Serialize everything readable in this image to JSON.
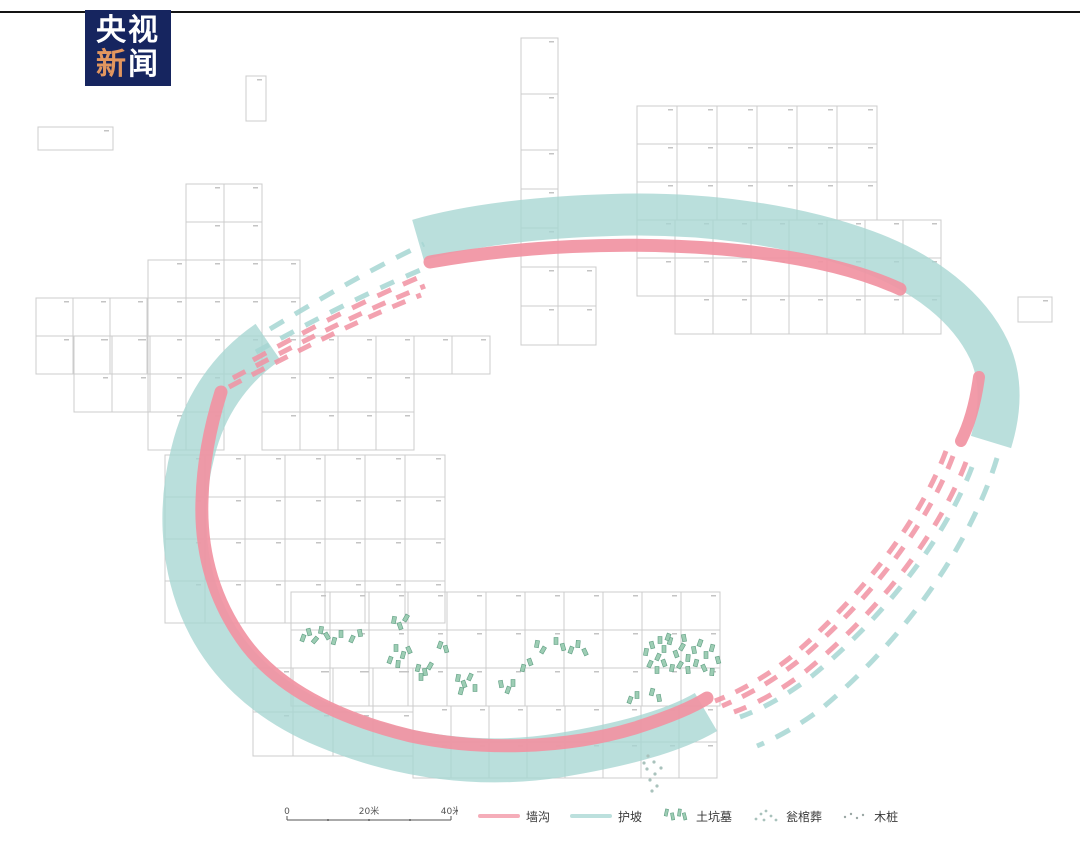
{
  "header": {
    "logo": {
      "char1": "央",
      "char2": "视",
      "char3": "新",
      "char4": "闻",
      "bg": "#16255f",
      "accent": "#e2965f",
      "text_color": "#ffffff"
    }
  },
  "colors": {
    "slope_teal": "#a6d6d2",
    "ditch_pink": "#f192a2",
    "grid_line": "#cccccc",
    "cell_mark": "#c4c4c4",
    "tomb_fill": "#9dcdb4",
    "tomb_stroke": "#5f9e82",
    "dot": "#a9c2bc",
    "scale_line": "#555555",
    "label_text": "#3a3a3a",
    "top_line": "#141414"
  },
  "legend": {
    "scale": {
      "labels": [
        "0",
        "20米",
        "40米"
      ]
    },
    "items": [
      {
        "type": "line",
        "color": "ditch_pink",
        "label": "墙沟"
      },
      {
        "type": "line",
        "color": "slope_teal",
        "label": "护坡"
      },
      {
        "type": "tombs",
        "label": "土坑墓"
      },
      {
        "type": "dots",
        "label": "瓮棺葬"
      },
      {
        "type": "dots",
        "label": "木桩"
      }
    ]
  },
  "plan": {
    "grid_clusters": [
      [
        521,
        38,
        1,
        2,
        37,
        56
      ],
      [
        521,
        150,
        1,
        5,
        37,
        39
      ],
      [
        558,
        267,
        1,
        2,
        38,
        39
      ],
      [
        637,
        106,
        6,
        3,
        40,
        38
      ],
      [
        637,
        220,
        8,
        2,
        38,
        38
      ],
      [
        675,
        296,
        7,
        1,
        38,
        38
      ],
      [
        186,
        184,
        2,
        2,
        38,
        38
      ],
      [
        148,
        260,
        4,
        3,
        38,
        38
      ],
      [
        36,
        298,
        3,
        2,
        37,
        38
      ],
      [
        74,
        336,
        2,
        2,
        38,
        38
      ],
      [
        148,
        374,
        2,
        2,
        38,
        38
      ],
      [
        300,
        336,
        5,
        1,
        38,
        38
      ],
      [
        262,
        374,
        4,
        2,
        38,
        38
      ],
      [
        165,
        455,
        7,
        4,
        40,
        42
      ],
      [
        291,
        592,
        11,
        3,
        39,
        38
      ],
      [
        253,
        668,
        4,
        2,
        40,
        44
      ],
      [
        413,
        706,
        8,
        2,
        38,
        36
      ],
      [
        246,
        76,
        1,
        1,
        20,
        45
      ],
      [
        38,
        127,
        1,
        1,
        75,
        23
      ],
      [
        1018,
        297,
        1,
        1,
        34,
        25
      ]
    ],
    "bands": [
      {
        "name": "slope-band-top",
        "d": "M 418,240 C 470,225 540,217 612,215 C 700,212 792,224 866,251 C 926,273 969,308 989,350 C 1001,376 1002,406 991,442",
        "color": "slope_teal",
        "w": 42,
        "o": 0.78,
        "cap": "butt"
      },
      {
        "name": "slope-band-left-bottom",
        "d": "M 268,342 C 230,368 204,406 193,452 C 180,502 181,557 201,607 C 223,661 266,701 326,726 C 400,757 482,768 561,755 C 621,745 672,732 706,712",
        "color": "slope_teal",
        "w": 44,
        "o": 0.78,
        "cap": "butt"
      },
      {
        "name": "ditch-band-top",
        "d": "M 430,262 C 520,246 622,241 722,249 C 792,255 852,267 900,289",
        "color": "ditch_pink",
        "w": 13,
        "o": 0.92,
        "cap": "round"
      },
      {
        "name": "ditch-band-right",
        "d": "M 979,377 C 976,399 971,421 961,441",
        "color": "ditch_pink",
        "w": 12,
        "o": 0.92,
        "cap": "round"
      },
      {
        "name": "ditch-band-left-bottom",
        "d": "M 221,392 C 209,430 203,465 202,500 C 200,554 215,604 247,646 C 282,691 341,719 411,736 C 481,751 566,749 635,728 C 663,719 690,709 707,698",
        "color": "ditch_pink",
        "w": 13,
        "o": 0.92,
        "cap": "round"
      }
    ],
    "dashed": [
      {
        "name": "slope-dashed-nw-outer",
        "d": "M 270,329 C 320,299 371,269 424,244",
        "color": "slope_teal",
        "w": 5,
        "dash": "16 13"
      },
      {
        "name": "slope-dashed-nw-mid",
        "d": "M 256,352 C 312,321 370,291 430,266",
        "color": "slope_teal",
        "w": 5,
        "dash": "15 13"
      },
      {
        "name": "ditch-dashed-nw-mid",
        "d": "M 253,360 C 309,329 367,299 427,274",
        "color": "ditch_pink",
        "w": 5,
        "dash": "15 13"
      },
      {
        "name": "ditch-dashed-nw-inner1",
        "d": "M 233,378 C 295,345 360,312 425,286",
        "color": "ditch_pink",
        "w": 5,
        "dash": "14 12"
      },
      {
        "name": "ditch-dashed-nw-inner2",
        "d": "M 229,387 C 291,354 356,321 421,295",
        "color": "ditch_pink",
        "w": 5,
        "dash": "14 12"
      },
      {
        "name": "ditch-dashed-se-inner1",
        "d": "M 946,451 C 919,523 860,598 791,657 C 763,679 736,693 715,701",
        "color": "ditch_pink",
        "w": 5,
        "dash": "14 12"
      },
      {
        "name": "ditch-dashed-se-inner2",
        "d": "M 953,456 C 926,528 867,603 797,662 C 769,684 743,697 722,706",
        "color": "ditch_pink",
        "w": 5,
        "dash": "14 12"
      },
      {
        "name": "ditch-dashed-se-mid",
        "d": "M 966,462 C 938,536 877,613 806,671 C 780,691 756,704 734,712",
        "color": "ditch_pink",
        "w": 5,
        "dash": "15 13"
      },
      {
        "name": "slope-dashed-se-mid",
        "d": "M 972,467 C 944,541 883,618 812,676 C 786,696 762,709 740,717",
        "color": "slope_teal",
        "w": 5,
        "dash": "15 13"
      },
      {
        "name": "slope-dashed-se-outer",
        "d": "M 997,458 C 971,544 905,639 821,709 C 797,727 774,739 757,746",
        "color": "slope_teal",
        "w": 5,
        "dash": "16 13"
      }
    ],
    "tombs": [
      [
        303,
        638,
        20
      ],
      [
        309,
        632,
        -15
      ],
      [
        315,
        640,
        40
      ],
      [
        321,
        630,
        10
      ],
      [
        327,
        636,
        -30
      ],
      [
        334,
        641,
        15
      ],
      [
        341,
        634,
        0
      ],
      [
        352,
        639,
        25
      ],
      [
        360,
        633,
        -10
      ],
      [
        394,
        620,
        10
      ],
      [
        400,
        626,
        -20
      ],
      [
        406,
        618,
        30
      ],
      [
        396,
        648,
        0
      ],
      [
        403,
        655,
        15
      ],
      [
        409,
        650,
        -25
      ],
      [
        390,
        660,
        20
      ],
      [
        398,
        664,
        5
      ],
      [
        418,
        668,
        15
      ],
      [
        425,
        672,
        -10
      ],
      [
        430,
        666,
        30
      ],
      [
        421,
        677,
        0
      ],
      [
        440,
        645,
        20
      ],
      [
        446,
        649,
        -15
      ],
      [
        458,
        678,
        10
      ],
      [
        464,
        684,
        -20
      ],
      [
        470,
        677,
        25
      ],
      [
        475,
        688,
        0
      ],
      [
        461,
        691,
        15
      ],
      [
        501,
        684,
        -10
      ],
      [
        508,
        690,
        20
      ],
      [
        513,
        683,
        0
      ],
      [
        523,
        668,
        15
      ],
      [
        530,
        662,
        -20
      ],
      [
        537,
        644,
        10
      ],
      [
        543,
        650,
        30
      ],
      [
        556,
        641,
        0
      ],
      [
        563,
        647,
        -15
      ],
      [
        571,
        650,
        20
      ],
      [
        578,
        644,
        5
      ],
      [
        585,
        652,
        -25
      ],
      [
        646,
        652,
        10
      ],
      [
        652,
        645,
        -15
      ],
      [
        658,
        657,
        25
      ],
      [
        664,
        649,
        0
      ],
      [
        670,
        641,
        15
      ],
      [
        676,
        654,
        -20
      ],
      [
        682,
        647,
        30
      ],
      [
        688,
        658,
        5
      ],
      [
        694,
        650,
        -10
      ],
      [
        700,
        643,
        20
      ],
      [
        706,
        655,
        0
      ],
      [
        712,
        648,
        15
      ],
      [
        718,
        660,
        -15
      ],
      [
        650,
        664,
        25
      ],
      [
        657,
        670,
        0
      ],
      [
        664,
        663,
        -20
      ],
      [
        672,
        668,
        10
      ],
      [
        680,
        665,
        30
      ],
      [
        688,
        670,
        -5
      ],
      [
        696,
        663,
        15
      ],
      [
        704,
        668,
        -25
      ],
      [
        712,
        672,
        5
      ],
      [
        660,
        640,
        0
      ],
      [
        668,
        637,
        20
      ],
      [
        684,
        638,
        -10
      ],
      [
        652,
        692,
        15
      ],
      [
        659,
        698,
        -10
      ],
      [
        630,
        700,
        20
      ],
      [
        637,
        695,
        0
      ]
    ],
    "dots": [
      [
        648,
        756
      ],
      [
        654,
        762
      ],
      [
        647,
        769
      ],
      [
        655,
        774
      ],
      [
        650,
        780
      ],
      [
        657,
        786
      ],
      [
        652,
        791
      ],
      [
        661,
        768
      ],
      [
        644,
        763
      ]
    ]
  }
}
